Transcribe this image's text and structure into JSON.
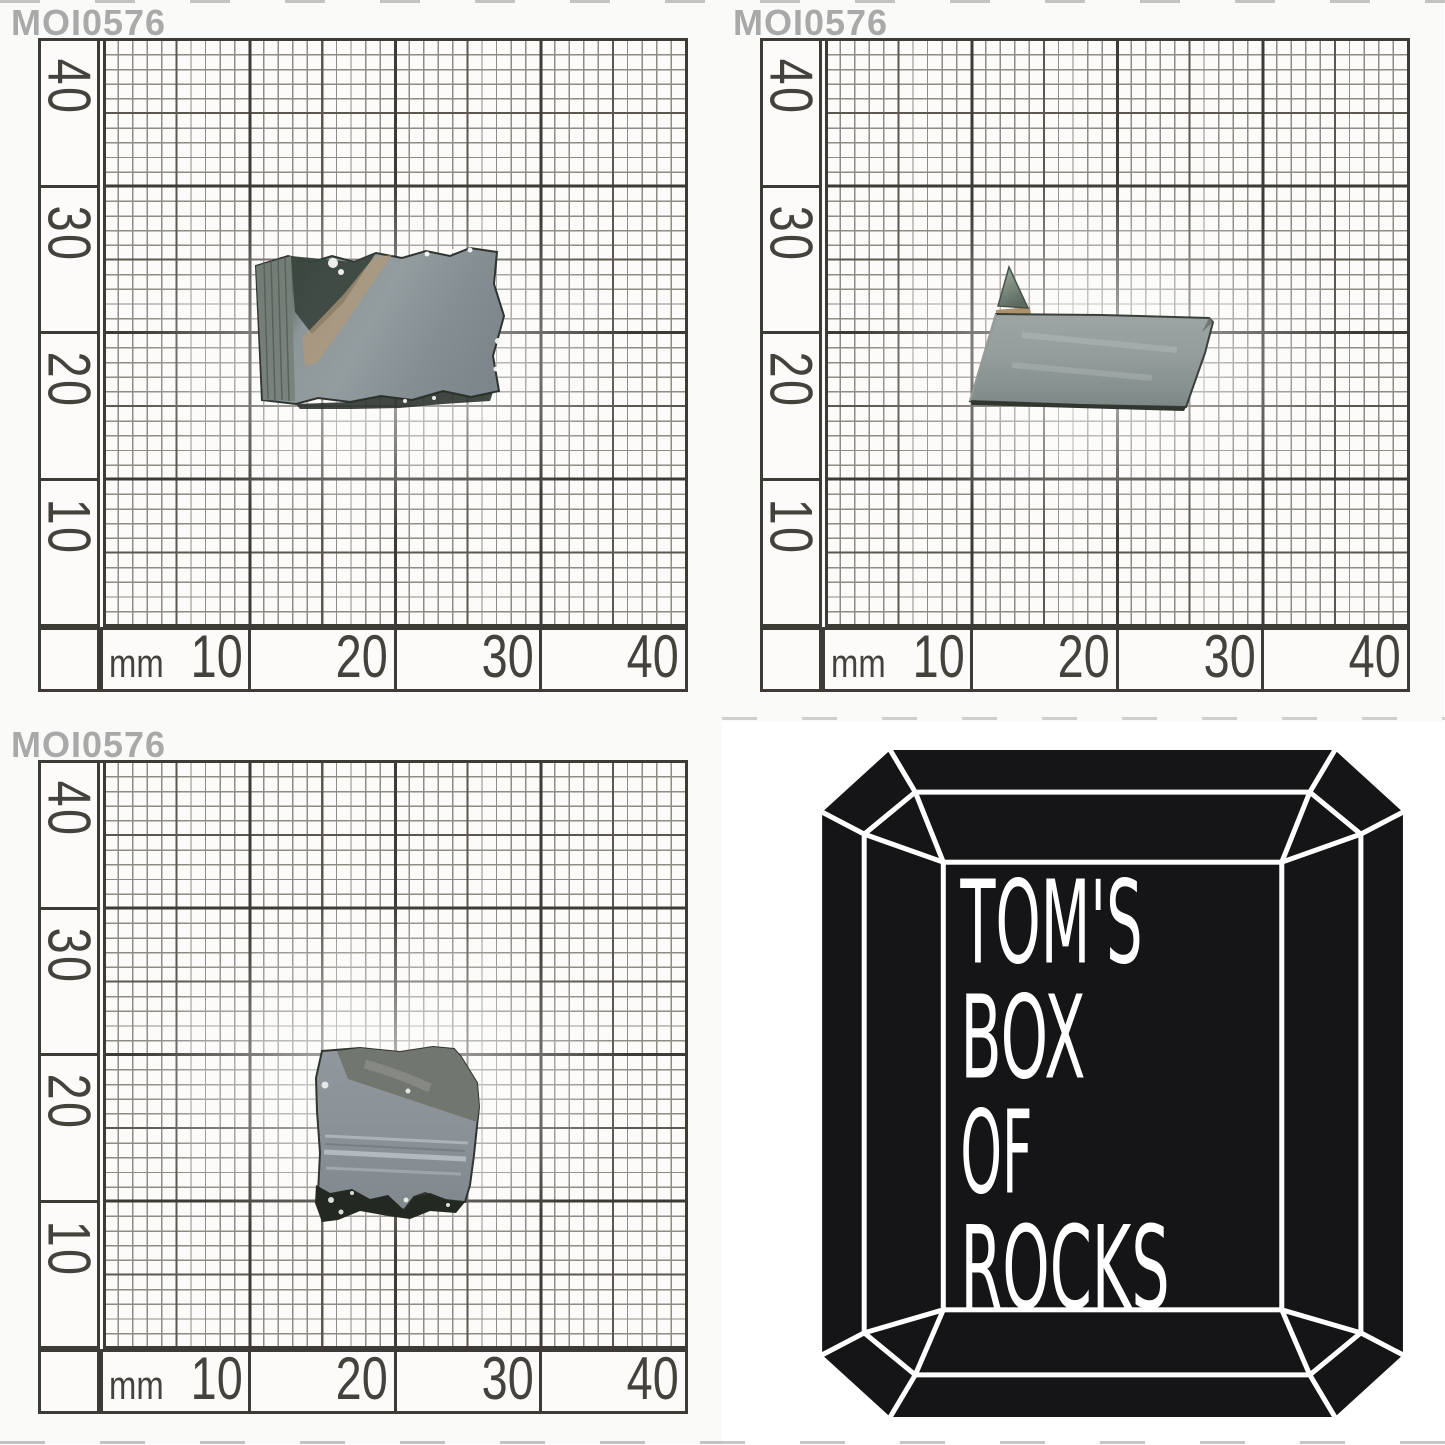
{
  "specimen": {
    "id": "MOI0576"
  },
  "axes": {
    "unit_label": "mm",
    "y_labels": [
      "40",
      "30",
      "20",
      "10"
    ],
    "x_labels": [
      "10",
      "20",
      "30",
      "40"
    ]
  },
  "logo": {
    "lines": [
      "TOM'S",
      "BOX",
      "OF",
      "ROCKS"
    ]
  },
  "colors": {
    "label_gray": "#a9a9a9",
    "axis_text": "#45413c",
    "grid_major": "#3e3a36",
    "grid_medium": "#5c5751",
    "grid_minor": "#8f8b85",
    "paper_bg": "#fcfbf9",
    "photo_bg": "#fafaf8",
    "gem_black": "#151417",
    "logo_text": "#ffffff",
    "specimen_tan": "#b29878",
    "specimen_dark_edge": "#272d28",
    "specimen_olive": "#71766e",
    "specimen_flap_dark": "#232921"
  }
}
